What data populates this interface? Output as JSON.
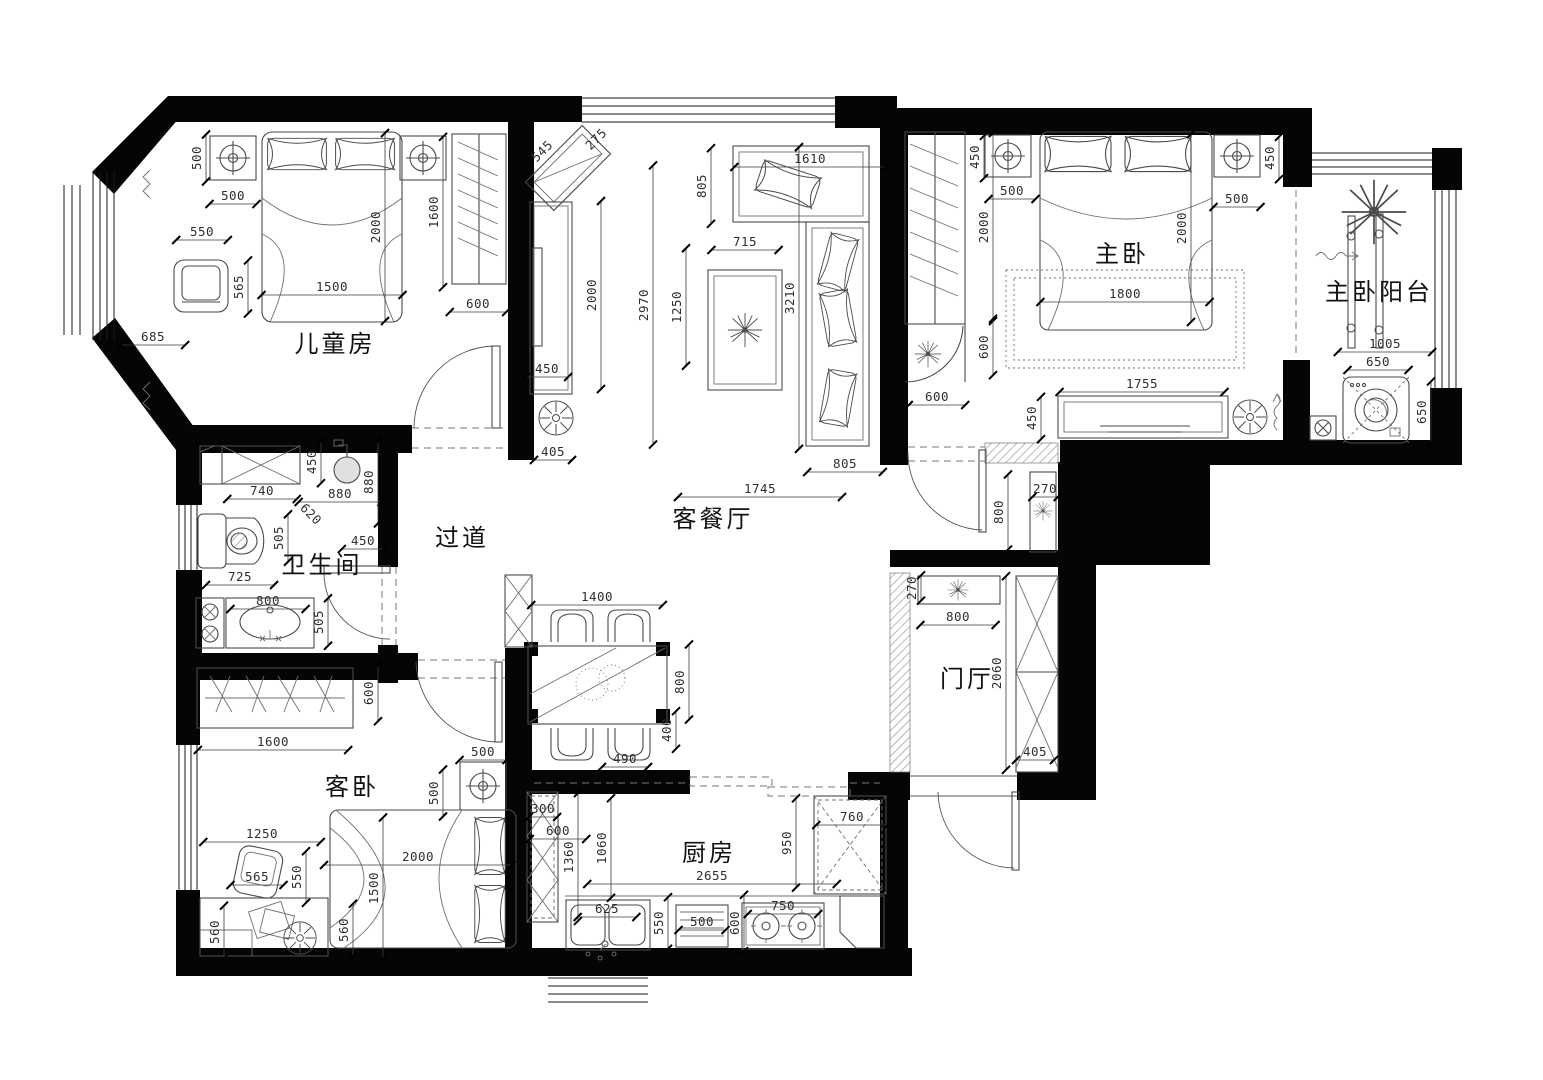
{
  "drawing": {
    "type": "apartment-floor-plan",
    "background": "#ffffff",
    "wall_color": "#050505",
    "furniture_line_color": "#4a4a4a",
    "dimension_color": "#2e2e2e",
    "units": "mm"
  },
  "rooms": [
    {
      "id": "children-room",
      "label": "儿童房",
      "x": 335,
      "y": 352,
      "fs": 25
    },
    {
      "id": "master-bedroom",
      "label": "主卧",
      "x": 1122,
      "y": 262,
      "fs": 25
    },
    {
      "id": "master-balcony",
      "label": "主卧阳台",
      "x": 1379,
      "y": 300,
      "fs": 21
    },
    {
      "id": "living-dining",
      "label": "客餐厅",
      "x": 713,
      "y": 527,
      "fs": 25
    },
    {
      "id": "hallway",
      "label": "过道",
      "x": 462,
      "y": 546,
      "fs": 25
    },
    {
      "id": "bathroom",
      "label": "卫生间",
      "x": 322,
      "y": 573,
      "fs": 21
    },
    {
      "id": "entrance-hall",
      "label": "门厅",
      "x": 967,
      "y": 687,
      "fs": 22
    },
    {
      "id": "guest-bedroom",
      "label": "客卧",
      "x": 352,
      "y": 795,
      "fs": 25
    },
    {
      "id": "kitchen",
      "label": "厨房",
      "x": 709,
      "y": 861,
      "fs": 22
    }
  ],
  "dimensions": [
    {
      "t": "500",
      "x": 198,
      "y": 158,
      "r": -90
    },
    {
      "t": "500",
      "x": 233,
      "y": 197,
      "r": 0
    },
    {
      "t": "550",
      "x": 202,
      "y": 233,
      "r": 0
    },
    {
      "t": "565",
      "x": 240,
      "y": 287,
      "r": -90
    },
    {
      "t": "1500",
      "x": 332,
      "y": 288,
      "r": 0
    },
    {
      "t": "2000",
      "x": 377,
      "y": 227,
      "r": -90
    },
    {
      "t": "1600",
      "x": 435,
      "y": 212,
      "r": -90
    },
    {
      "t": "600",
      "x": 478,
      "y": 305,
      "r": 0
    },
    {
      "t": "685",
      "x": 153,
      "y": 338,
      "r": 0
    },
    {
      "t": "545",
      "x": 543,
      "y": 152,
      "r": -45
    },
    {
      "t": "275",
      "x": 597,
      "y": 140,
      "r": -45
    },
    {
      "t": "805",
      "x": 703,
      "y": 186,
      "r": -90
    },
    {
      "t": "1610",
      "x": 810,
      "y": 160,
      "r": 0
    },
    {
      "t": "715",
      "x": 745,
      "y": 243,
      "r": 0
    },
    {
      "t": "2000",
      "x": 593,
      "y": 295,
      "r": -90
    },
    {
      "t": "2970",
      "x": 645,
      "y": 305,
      "r": -90
    },
    {
      "t": "1250",
      "x": 678,
      "y": 307,
      "r": -90
    },
    {
      "t": "3210",
      "x": 791,
      "y": 298,
      "r": -90
    },
    {
      "t": "450",
      "x": 547,
      "y": 370,
      "r": 0
    },
    {
      "t": "405",
      "x": 553,
      "y": 453,
      "r": 0
    },
    {
      "t": "805",
      "x": 845,
      "y": 465,
      "r": 0
    },
    {
      "t": "1745",
      "x": 760,
      "y": 490,
      "r": 0
    },
    {
      "t": "450",
      "x": 976,
      "y": 157,
      "r": -90
    },
    {
      "t": "500",
      "x": 1012,
      "y": 192,
      "r": 0
    },
    {
      "t": "2000",
      "x": 985,
      "y": 227,
      "r": -90
    },
    {
      "t": "2000",
      "x": 1183,
      "y": 228,
      "r": -90
    },
    {
      "t": "500",
      "x": 1237,
      "y": 200,
      "r": 0
    },
    {
      "t": "450",
      "x": 1271,
      "y": 158,
      "r": -90
    },
    {
      "t": "1800",
      "x": 1125,
      "y": 295,
      "r": 0
    },
    {
      "t": "600",
      "x": 985,
      "y": 347,
      "r": -90
    },
    {
      "t": "600",
      "x": 937,
      "y": 398,
      "r": 0
    },
    {
      "t": "1755",
      "x": 1142,
      "y": 385,
      "r": 0
    },
    {
      "t": "450",
      "x": 1033,
      "y": 418,
      "r": -90
    },
    {
      "t": "1005",
      "x": 1385,
      "y": 345,
      "r": 0
    },
    {
      "t": "650",
      "x": 1378,
      "y": 363,
      "r": 0
    },
    {
      "t": "650",
      "x": 1423,
      "y": 412,
      "r": -90
    },
    {
      "t": "450",
      "x": 313,
      "y": 462,
      "r": -90
    },
    {
      "t": "740",
      "x": 262,
      "y": 492,
      "r": 0
    },
    {
      "t": "880",
      "x": 340,
      "y": 495,
      "r": 0
    },
    {
      "t": "880",
      "x": 370,
      "y": 482,
      "r": -90
    },
    {
      "t": "620",
      "x": 310,
      "y": 515,
      "r": 45
    },
    {
      "t": "505",
      "x": 280,
      "y": 538,
      "r": -90
    },
    {
      "t": "450",
      "x": 363,
      "y": 542,
      "r": 0
    },
    {
      "t": "725",
      "x": 240,
      "y": 578,
      "r": 0
    },
    {
      "t": "800",
      "x": 268,
      "y": 602,
      "r": 0
    },
    {
      "t": "505",
      "x": 320,
      "y": 622,
      "r": -90
    },
    {
      "t": "1400",
      "x": 597,
      "y": 598,
      "r": 0
    },
    {
      "t": "800",
      "x": 681,
      "y": 682,
      "r": -90
    },
    {
      "t": "400",
      "x": 668,
      "y": 730,
      "r": -90
    },
    {
      "t": "490",
      "x": 625,
      "y": 760,
      "r": 0
    },
    {
      "t": "500",
      "x": 483,
      "y": 753,
      "r": 0
    },
    {
      "t": "270",
      "x": 1045,
      "y": 490,
      "r": 0
    },
    {
      "t": "800",
      "x": 1000,
      "y": 512,
      "r": -90
    },
    {
      "t": "270",
      "x": 913,
      "y": 588,
      "r": -90
    },
    {
      "t": "800",
      "x": 958,
      "y": 618,
      "r": 0
    },
    {
      "t": "2060",
      "x": 998,
      "y": 673,
      "r": -90
    },
    {
      "t": "405",
      "x": 1035,
      "y": 753,
      "r": 0
    },
    {
      "t": "600",
      "x": 370,
      "y": 693,
      "r": -90
    },
    {
      "t": "1600",
      "x": 273,
      "y": 743,
      "r": 0
    },
    {
      "t": "500",
      "x": 435,
      "y": 793,
      "r": -90
    },
    {
      "t": "1250",
      "x": 262,
      "y": 835,
      "r": 0
    },
    {
      "t": "565",
      "x": 257,
      "y": 878,
      "r": 0
    },
    {
      "t": "550",
      "x": 298,
      "y": 877,
      "r": -90
    },
    {
      "t": "2000",
      "x": 418,
      "y": 858,
      "r": 0
    },
    {
      "t": "1500",
      "x": 375,
      "y": 888,
      "r": -90
    },
    {
      "t": "560",
      "x": 216,
      "y": 932,
      "r": -90
    },
    {
      "t": "560",
      "x": 345,
      "y": 930,
      "r": -90
    },
    {
      "t": "300",
      "x": 543,
      "y": 810,
      "r": 0
    },
    {
      "t": "600",
      "x": 558,
      "y": 832,
      "r": 0
    },
    {
      "t": "1360",
      "x": 570,
      "y": 857,
      "r": -90
    },
    {
      "t": "1060",
      "x": 603,
      "y": 848,
      "r": -90
    },
    {
      "t": "2655",
      "x": 712,
      "y": 877,
      "r": 0
    },
    {
      "t": "950",
      "x": 788,
      "y": 843,
      "r": -90
    },
    {
      "t": "760",
      "x": 852,
      "y": 818,
      "r": 0
    },
    {
      "t": "625",
      "x": 607,
      "y": 910,
      "r": 0
    },
    {
      "t": "550",
      "x": 660,
      "y": 923,
      "r": -90
    },
    {
      "t": "500",
      "x": 702,
      "y": 923,
      "r": 0
    },
    {
      "t": "600",
      "x": 736,
      "y": 923,
      "r": -90
    },
    {
      "t": "750",
      "x": 783,
      "y": 907,
      "r": 0
    }
  ]
}
